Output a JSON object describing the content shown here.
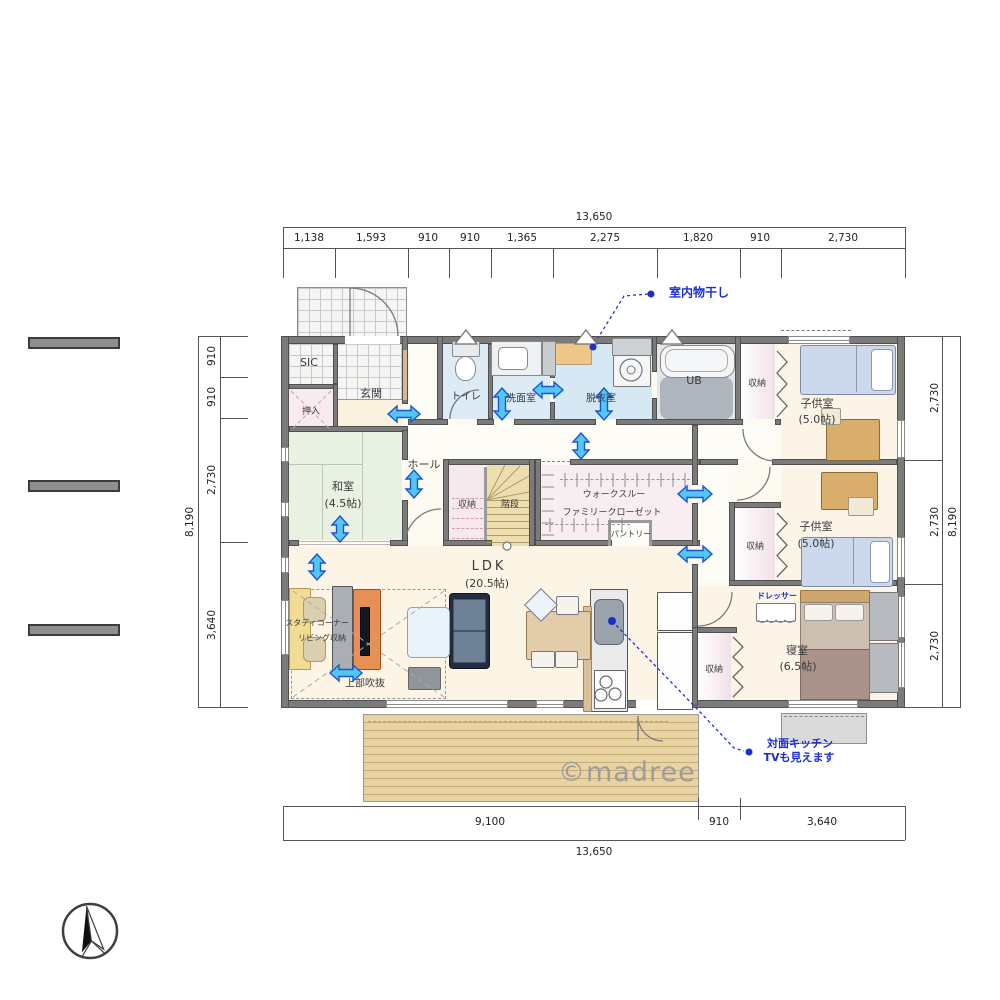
{
  "watermark": "©madree",
  "dimensions": {
    "top": {
      "total": "13,650",
      "segments": [
        "1,138",
        "1,593",
        "910",
        "910",
        "1,365",
        "2,275",
        "1,820",
        "910",
        "2,730"
      ]
    },
    "bottom": {
      "total": "13,650",
      "segments": [
        "9,100",
        "910",
        "3,640"
      ]
    },
    "left": {
      "total": "8,190",
      "segments": [
        "910",
        "910",
        "2,730",
        "3,640"
      ]
    },
    "right": {
      "total": "8,190",
      "segments": [
        "2,730",
        "2,730",
        "2,730"
      ]
    }
  },
  "rooms": {
    "sic": "SIC",
    "genkan": "玄関",
    "oshiire": "押入",
    "toilet": "トイレ",
    "senmen": "洗面室",
    "datsui": "脱衣室",
    "ub": "UB",
    "hall": "ホール",
    "washitsu_name": "和室",
    "washitsu_size": "(4.5帖)",
    "closet": "収納",
    "stairs": "階段",
    "wtc_line1": "ウォークスルー",
    "wtc_line2": "ファミリークローゼット",
    "pantry": "パントリー",
    "ldk_name": "LDK",
    "ldk_size": "(20.5帖)",
    "kids_name": "子供室",
    "kids_size": "(5.0帖)",
    "bedroom_name": "寝室",
    "bedroom_size": "(6.5帖)",
    "study": "スタディコーナー",
    "living_storage": "リビング収納",
    "void": "上部吹抜"
  },
  "annotations": {
    "drying": "室内物干し",
    "kitchen1": "対面キッチン",
    "kitchen2": "TVも見えます",
    "dresser": "ドレッサー"
  },
  "icons": {
    "compass": "north-compass-icon"
  },
  "colors": {
    "annotation_blue": "#1b2fd0",
    "arrow_fill": "#53c6f3",
    "arrow_stroke": "#1b55cb",
    "wall": "#7b7b7b",
    "tatami": "#e9f1e2",
    "water_room": "#dcebf6",
    "closet_pink": "#f2e0e8",
    "stair_tan": "#eddeb0",
    "deck_wood": "#e7d3a4",
    "floor_cream": "#fcf4e4"
  }
}
